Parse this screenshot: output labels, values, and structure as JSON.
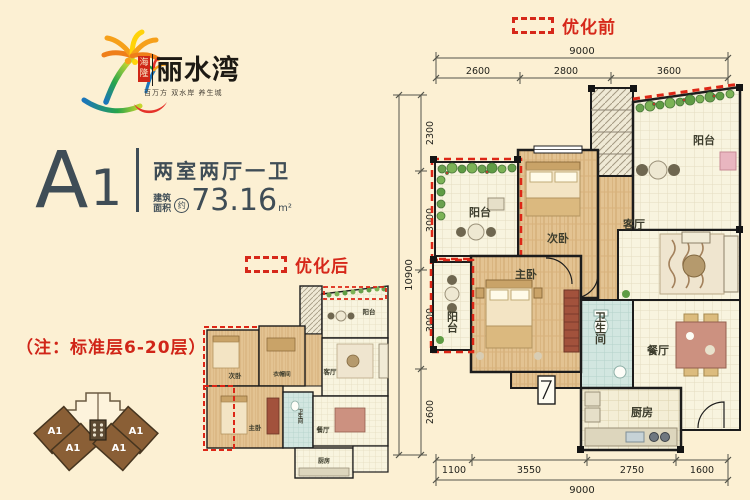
{
  "colors": {
    "bg": "#fcf0d3",
    "accent_red": "#d6281a",
    "slate": "#3f4d56",
    "brown": "#8a5f36"
  },
  "logo": {
    "brand": "丽水湾",
    "seal": "海隆",
    "tagline": "百万方 双水岸 养生城"
  },
  "unit": {
    "letter": "A",
    "number": "1",
    "layout": "两室两厅一卫",
    "area_label1": "建筑",
    "area_label2": "面积",
    "approx": "约",
    "area_value": "73.16",
    "area_unit": "m²"
  },
  "note": "（注：标准层6-20层）",
  "optimize": {
    "before": "优化前",
    "after": "优化后"
  },
  "site": {
    "units": [
      "A1",
      "A1",
      "A1",
      "A1"
    ]
  },
  "plan_before": {
    "rooms": {
      "balcony_tr": "阳台",
      "balcony_ul": "阳台",
      "balcony_ll": "阳台",
      "second_bed": "次卧",
      "living": "客厅",
      "master_bed": "主卧",
      "bath": "卫生间",
      "dining": "餐厅",
      "kitchen": "厨房"
    },
    "dim_top_total": "9000",
    "dim_top": [
      "2600",
      "2800",
      "3600"
    ],
    "dim_left_total": "10900",
    "dim_left": [
      "2300",
      "3000",
      "3000",
      "2600"
    ],
    "dim_bottom": [
      "1100",
      "3550",
      "2750",
      "1600"
    ],
    "dim_bottom_total": "9000"
  },
  "plan_after": {
    "rooms": {
      "second_bed": "次卧",
      "cloak": "衣帽间",
      "balcony": "阳台",
      "living": "客厅",
      "master_bed": "主卧",
      "bath": "卫生间",
      "dining": "餐厅",
      "kitchen": "厨房"
    }
  }
}
